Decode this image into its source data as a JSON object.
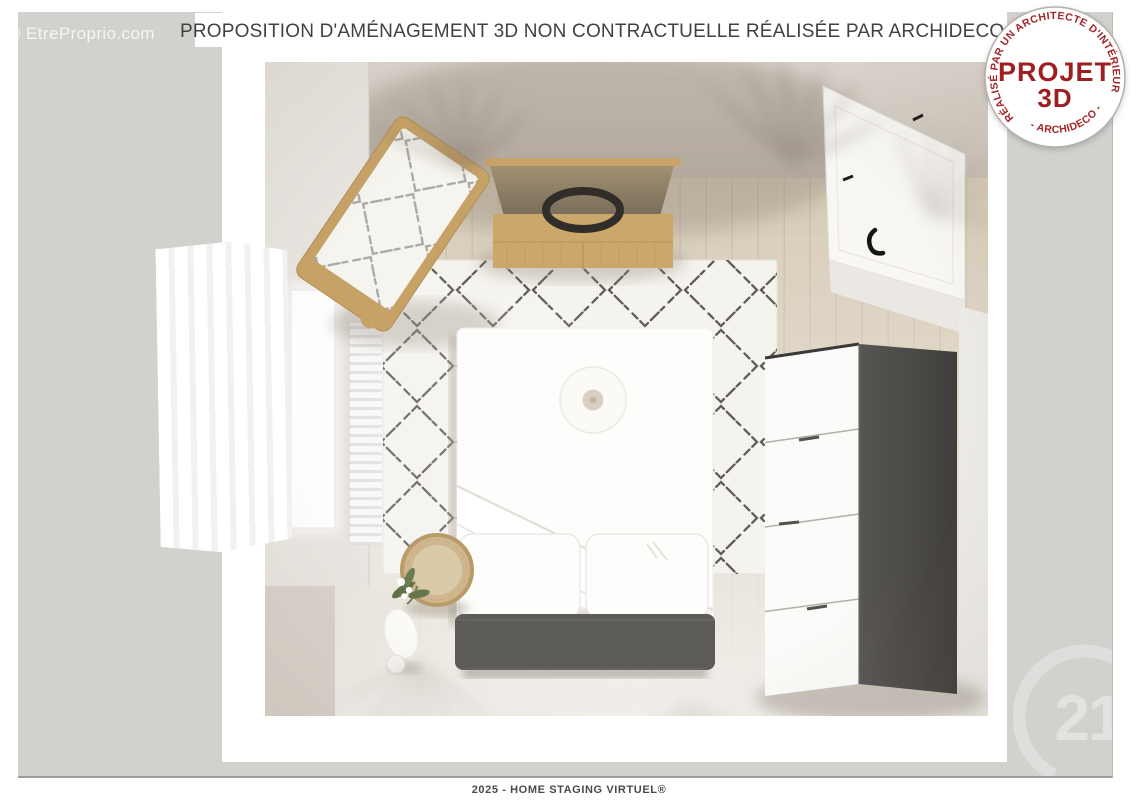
{
  "header": {
    "title": "PROPOSITION D'AMÉNAGEMENT 3D NON CONTRACTUELLE RÉALISÉE PAR ARCHIDECO ©",
    "watermark": "© EtreProprio.com"
  },
  "stamp": {
    "arc_top": "· RÉALISÉ PAR UN ARCHITECTE D'INTÉRIEUR ·",
    "arc_bottom": "- ARCHIDECO -",
    "title_line1": "PROJET",
    "title_line2": "3D",
    "accent_color": "#9e1f22"
  },
  "footer": {
    "text": "2025 - HOME STAGING VIRTUEL®"
  },
  "agency_logo": {
    "number": "21"
  },
  "colors": {
    "canvas_gray": "#d2d1ce",
    "frame_white": "#ffffff",
    "title_text": "#434140",
    "stamp_red": "#9e1f22",
    "logo_gray": "#e2e2e0"
  }
}
